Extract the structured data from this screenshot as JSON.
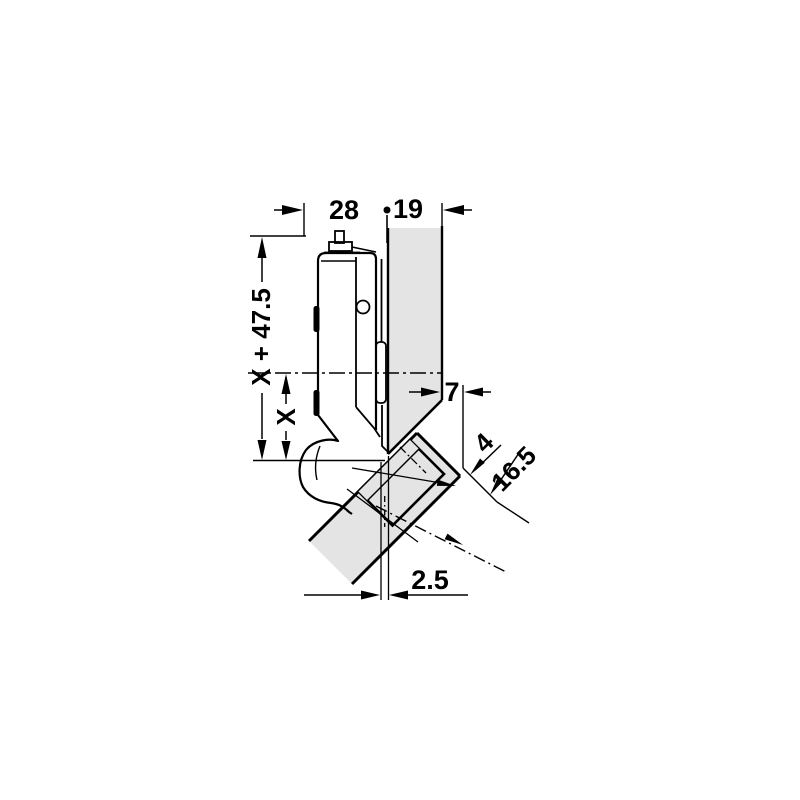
{
  "diagram": {
    "type": "technical-drawing",
    "subject": "concealed hinge 45-degree corner mounting diagram",
    "dimensions": {
      "arm_to_panel_face": "28",
      "panel_thickness": "19",
      "height_total": "X + 47.5",
      "height_x": "X",
      "edge_distance": "7",
      "end_gap": "4",
      "cup_edge_distance": "16.5",
      "cup_offset": "2.5"
    },
    "colors": {
      "panel_fill": "#e4e4e4",
      "line": "#000000",
      "background": "#ffffff"
    }
  }
}
